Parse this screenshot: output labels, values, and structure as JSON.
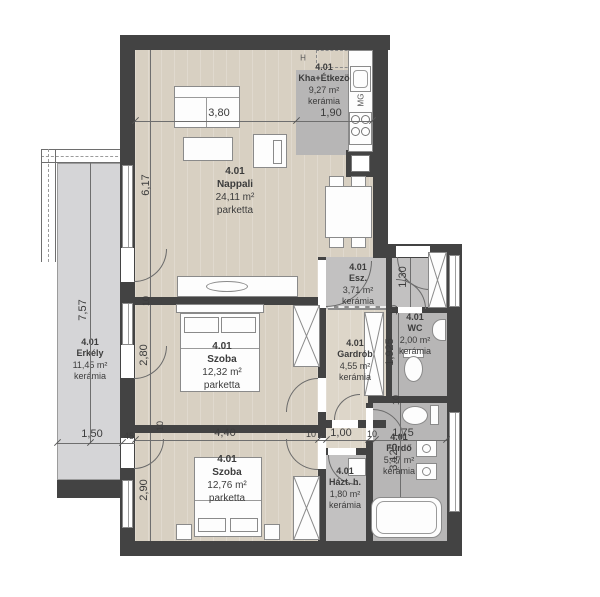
{
  "rooms": {
    "kha": {
      "number": "4.01",
      "name": "Kha+Étkezö",
      "area": "9,27 m²",
      "floor": "kerámia"
    },
    "nappali": {
      "number": "4.01",
      "name": "Nappali",
      "area": "24,11 m²",
      "floor": "parketta"
    },
    "erkely": {
      "number": "4.01",
      "name": "Erkély",
      "area": "11,45 m²",
      "floor": "kerámia"
    },
    "esz": {
      "number": "4.01",
      "name": "Esz.",
      "area": "3,71 m²",
      "floor": "kerámia"
    },
    "wc": {
      "number": "4.01",
      "name": "WC",
      "area": "2,00 m²",
      "floor": "kerámia"
    },
    "gardrob": {
      "number": "4.01",
      "name": "Gardrób",
      "area": "4,55 m²",
      "floor": "kerámia"
    },
    "szoba1": {
      "number": "4.01",
      "name": "Szoba",
      "area": "12,32 m²",
      "floor": "parketta"
    },
    "szoba2": {
      "number": "4.01",
      "name": "Szoba",
      "area": "12,76 m²",
      "floor": "parketta"
    },
    "hazt": {
      "number": "4.01",
      "name": "Házt. h.",
      "area": "1,80 m²",
      "floor": "kerámia"
    },
    "furdo": {
      "number": "4.01",
      "name": "Fürdő",
      "area": "5,47 m²",
      "floor": "kerámia"
    }
  },
  "dims": {
    "w380": "3,80",
    "w190": "1,90",
    "h617": "6,17",
    "h757": "7,57",
    "w150": "1,50",
    "h280": "2,80",
    "h290": "2,90",
    "w440": "4,40",
    "w100": "1,00",
    "w175": "1,75",
    "h130": "1,30",
    "h1925": "1,925",
    "h3125": "3,125",
    "t10": "10",
    "t45": "45"
  },
  "appliances": {
    "fridge": "H",
    "dishwasher": "MG"
  },
  "colors": {
    "wall": "#434343",
    "parquet": "#d8d0c2",
    "ceramic_dark": "#b7b6b6",
    "ceramic": "#c2c1c1",
    "balcony": "#d5d5d7"
  }
}
